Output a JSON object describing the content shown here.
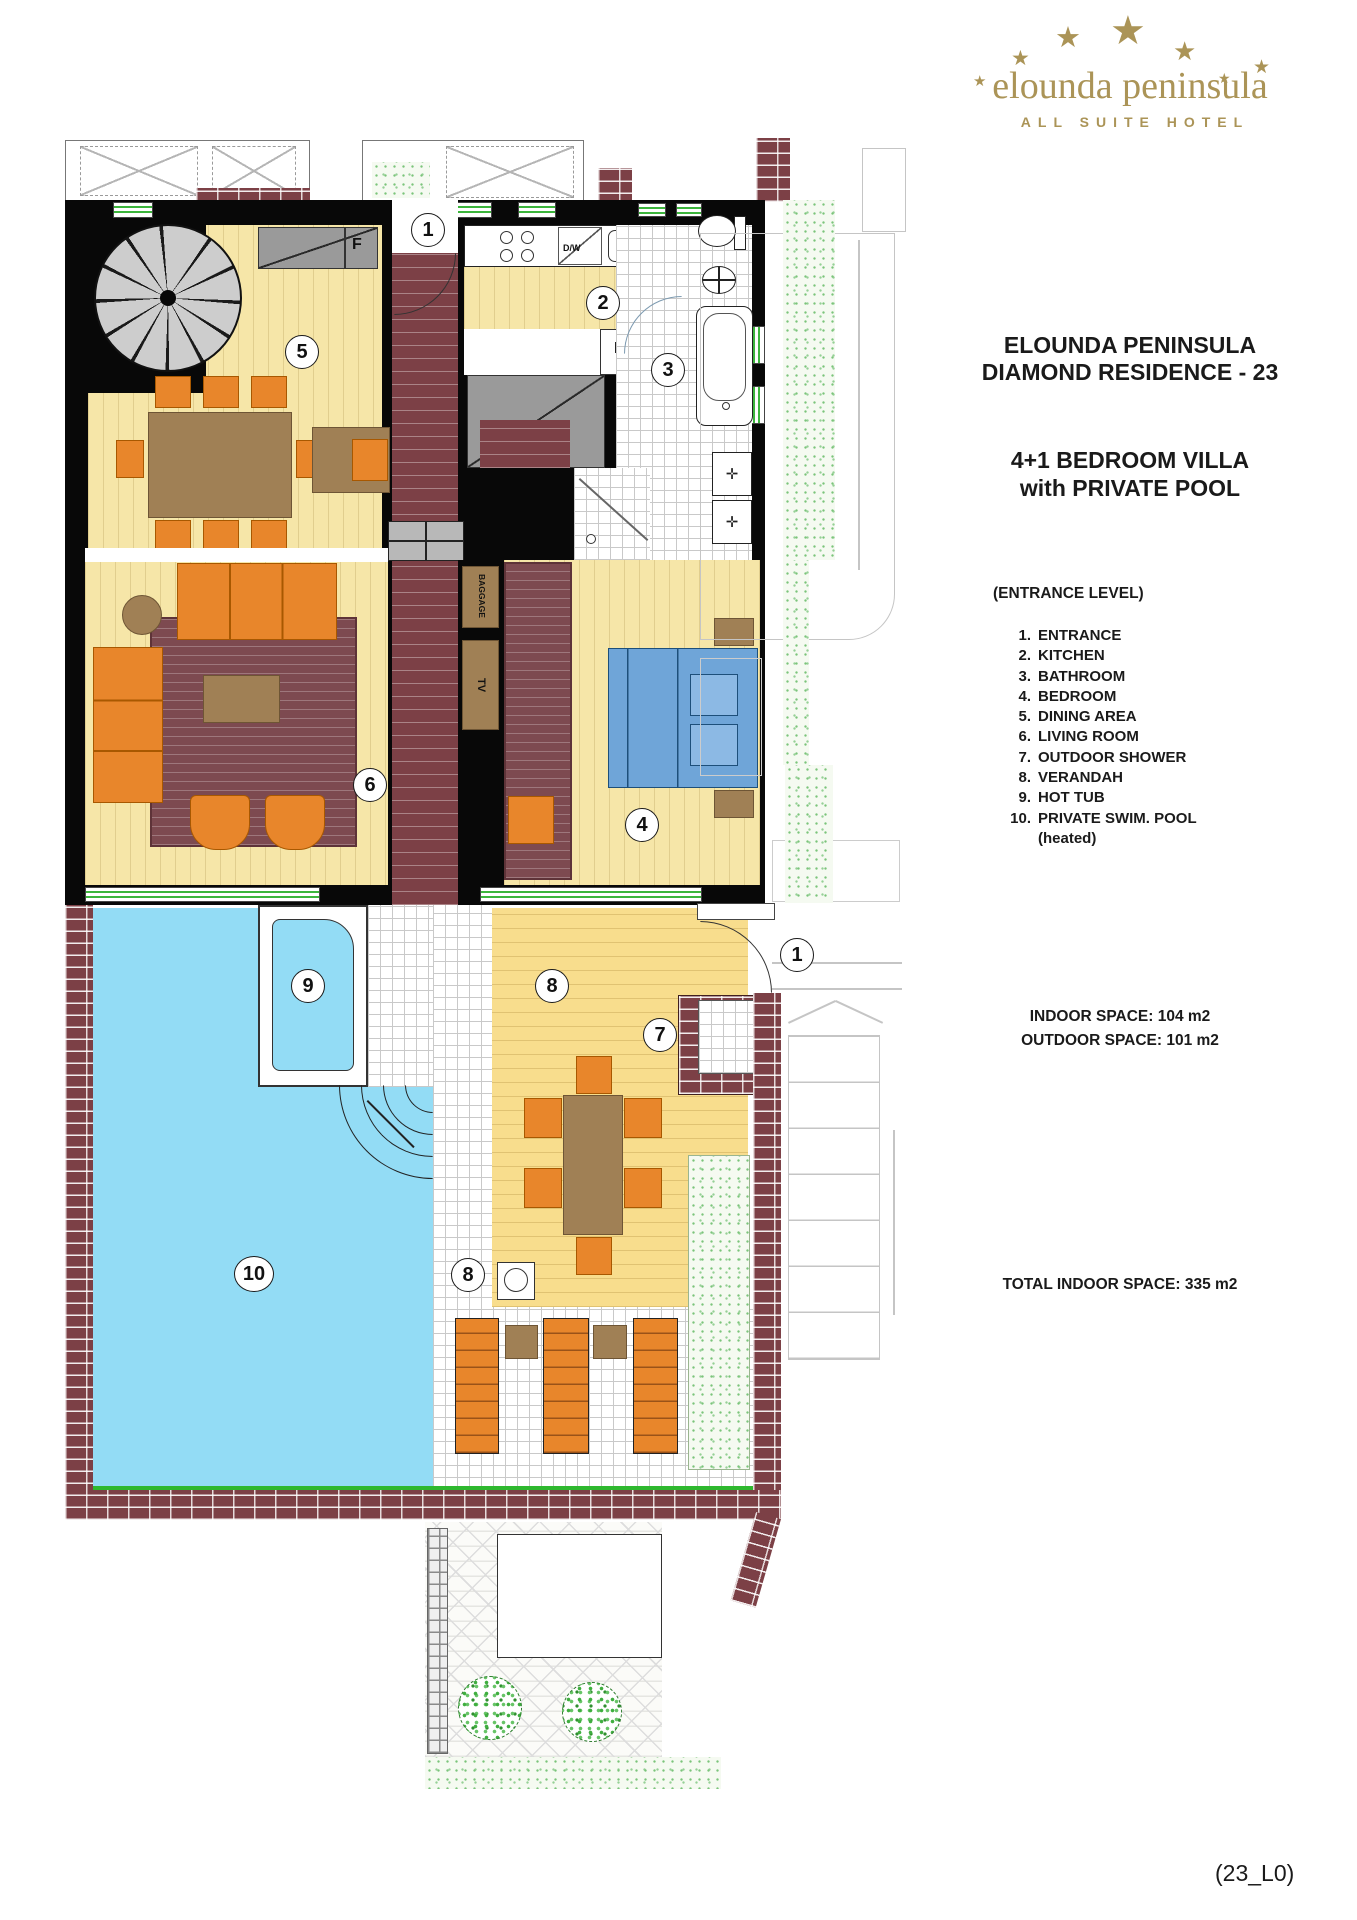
{
  "logo": {
    "star": "★",
    "name": "elounda peninsula",
    "subtitle": "ALL SUITE HOTEL"
  },
  "header": {
    "title_line1": "ELOUNDA PENINSULA",
    "title_line2": "DIAMOND RESIDENCE - 23",
    "subtitle_line1": "4+1 BEDROOM VILLA",
    "subtitle_line2": "with PRIVATE POOL"
  },
  "legend": {
    "heading": "(ENTRANCE LEVEL)",
    "items": [
      {
        "num": "1.",
        "label": "ENTRANCE"
      },
      {
        "num": "2.",
        "label": "KITCHEN"
      },
      {
        "num": "3.",
        "label": "BATHROOM"
      },
      {
        "num": "4.",
        "label": "BEDROOM"
      },
      {
        "num": "5.",
        "label": "DINING AREA"
      },
      {
        "num": "6.",
        "label": "LIVING ROOM"
      },
      {
        "num": "7.",
        "label": "OUTDOOR SHOWER"
      },
      {
        "num": "8.",
        "label": "VERANDAH"
      },
      {
        "num": "9.",
        "label": "HOT TUB"
      },
      {
        "num": "10.",
        "label": "PRIVATE SWIM. POOL",
        "note": "(heated)"
      }
    ]
  },
  "areas": {
    "indoor_label": "INDOOR SPACE:",
    "indoor_value": "104 m2",
    "outdoor_label": "OUTDOOR SPACE:",
    "outdoor_value": "101 m2",
    "total_label": "TOTAL INDOOR SPACE:",
    "total_value": "335 m2"
  },
  "footer": {
    "sheet": "(23_L0)"
  },
  "plan": {
    "labels": {
      "entrance_top": "1",
      "entrance_side": "1",
      "kitchen": "2",
      "bathroom": "3",
      "bedroom": "4",
      "dining": "5",
      "living": "6",
      "outdoor_shower": "7",
      "verandah_top": "8",
      "verandah_bottom": "8",
      "hot_tub": "9",
      "pool": "10"
    },
    "annotations": {
      "closet_f": "F",
      "fridge_f": "F",
      "dishwasher": "D/W",
      "tv": "TV",
      "baggage": "BAGGAGE"
    }
  },
  "colors": {
    "gold": "#ab9457",
    "wood": "#f6e6a8",
    "deck": "#f8dd8d",
    "brick": "#7c4046",
    "rug": "#7d4a50",
    "orange": "#e8862b",
    "orangedark": "#a85800",
    "brown": "#a08055",
    "pool": "#93dcf5",
    "bed": "#6fa5d8",
    "closet": "#9a9a9a",
    "wingreen": "#3cb53c",
    "speck": "#7bc47b",
    "tileline": "#c9c9c9"
  }
}
